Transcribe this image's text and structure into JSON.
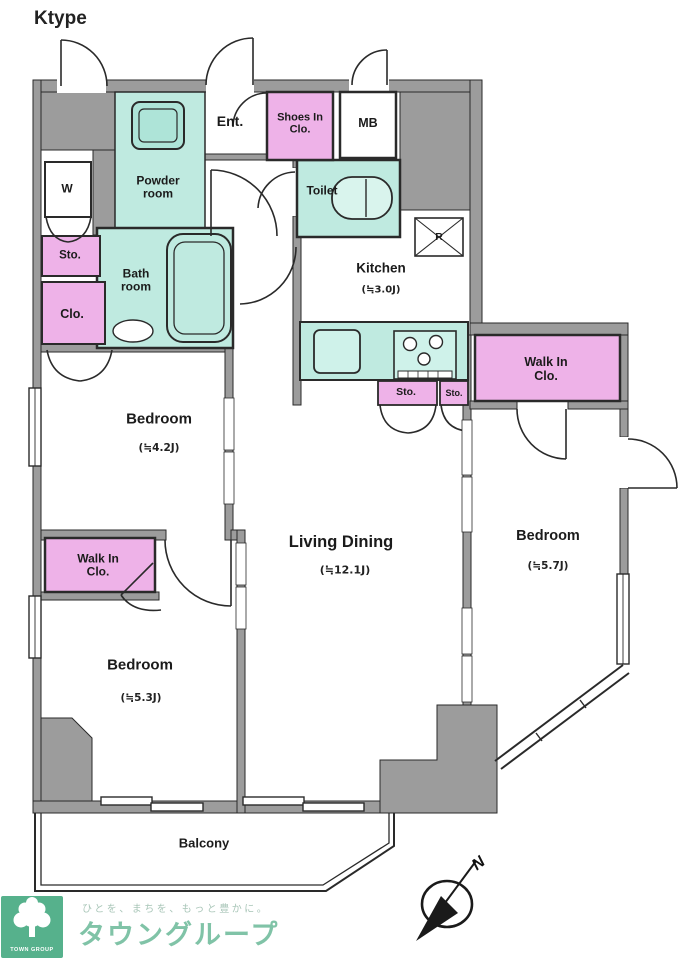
{
  "plan": {
    "type_label": "Ktype",
    "compass": {
      "north_label": "N"
    },
    "rooms": {
      "ent": {
        "label": "Ent."
      },
      "shoes_in_closet": {
        "label": "Shoes In Clo."
      },
      "meter_box": {
        "label": "MB"
      },
      "powder_room": {
        "label": "Powder room"
      },
      "toilet": {
        "label": "Toilet"
      },
      "washer": {
        "label": "W"
      },
      "storage_hall": {
        "label": "Sto."
      },
      "bath_room": {
        "label": "Bath room"
      },
      "closet_hall": {
        "label": "Clo."
      },
      "kitchen": {
        "label": "Kitchen",
        "size": "(≒3.0J)"
      },
      "refrigerator": {
        "label": "R"
      },
      "storage_kitchen_left": {
        "label": "Sto."
      },
      "storage_kitchen_right": {
        "label": "Sto."
      },
      "walk_in_closet_right": {
        "label": "Walk In Clo."
      },
      "walk_in_closet_left": {
        "label": "Walk In Clo."
      },
      "bedroom_upper_left": {
        "label": "Bedroom",
        "size": "(≒4.2J)"
      },
      "bedroom_lower_left": {
        "label": "Bedroom",
        "size": "(≒5.3J)"
      },
      "bedroom_right": {
        "label": "Bedroom",
        "size": "(≒5.7J)"
      },
      "living_dining": {
        "label": "Living Dining",
        "size": "(≒12.1J)"
      },
      "balcony": {
        "label": "Balcony"
      }
    }
  },
  "footer": {
    "logo_mark_text": "TOWN GROUP",
    "tagline": "ひとを、まちを、もっと豊かに。",
    "brand": "タウングループ"
  },
  "colors": {
    "room_teal": "#bfeae0",
    "closet_pink": "#eeb2e8",
    "wall_gray": "#9c9c9c",
    "logo_green": "#56b18c",
    "brand_green": "#80c3a7"
  }
}
